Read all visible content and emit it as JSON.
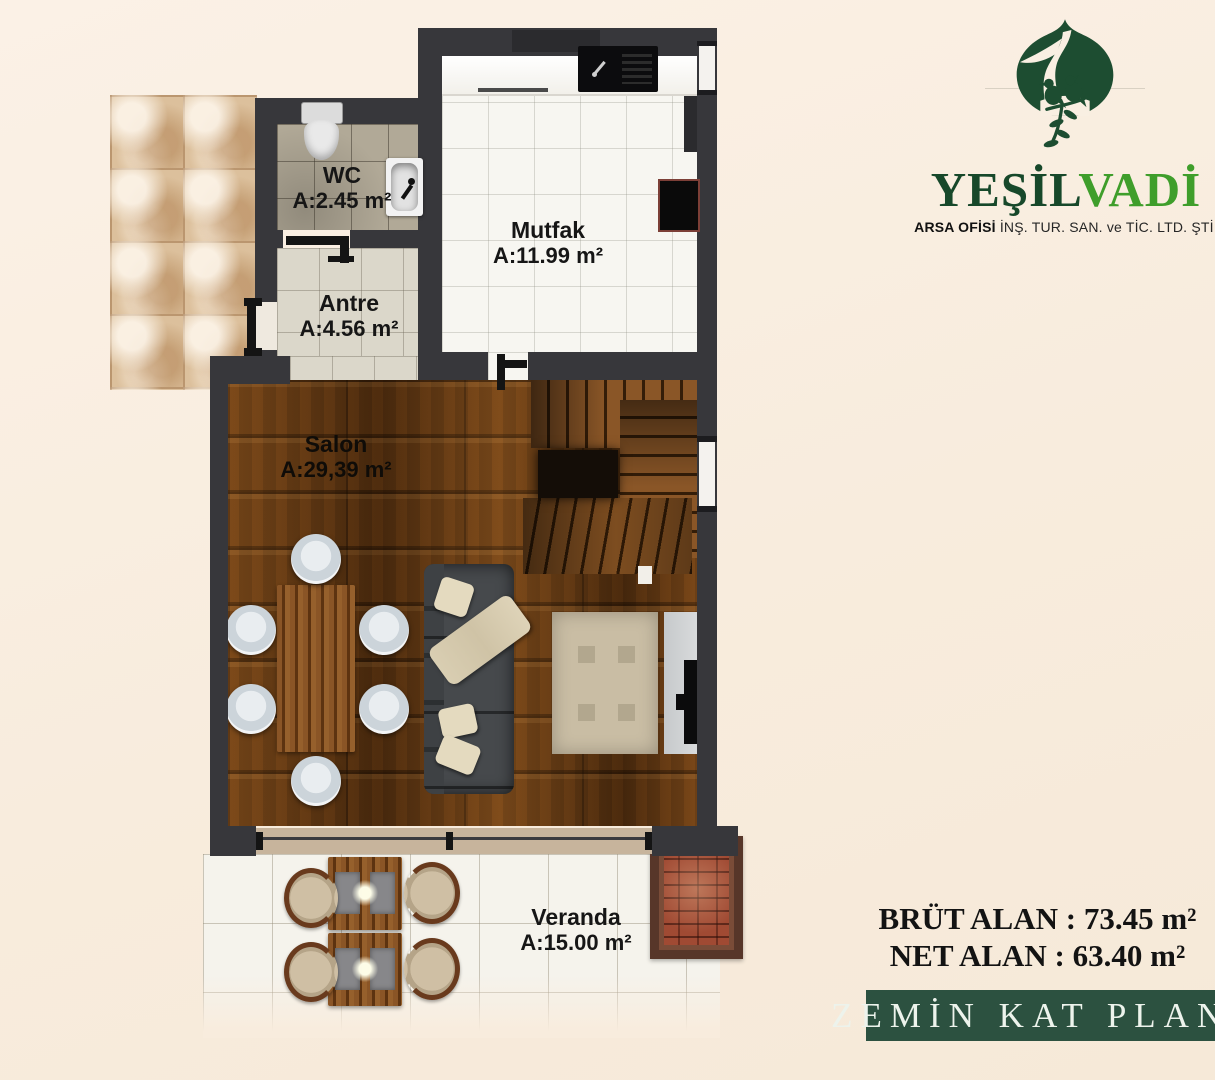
{
  "logo": {
    "brand_part1": "YEŞİL",
    "brand_part2": "VADİ",
    "tagline_bold": "ARSA OFİSİ",
    "tagline_rest": " İNŞ. TUR. SAN. ve TİC. LTD. ŞTİ.",
    "emblem": "valley-birds-emblem",
    "colors": {
      "dark_green": "#17482a",
      "light_green": "#3f9e2b"
    }
  },
  "plan": {
    "rooms": {
      "wc": {
        "name": "WC",
        "area": "A:2.45 m²"
      },
      "antre": {
        "name": "Antre",
        "area": "A:4.56 m²"
      },
      "mutfak": {
        "name": "Mutfak",
        "area": "A:11.99 m²"
      },
      "salon": {
        "name": "Salon",
        "area": "A:29,39 m²"
      },
      "veranda": {
        "name": "Veranda",
        "area": "A:15.00 m²"
      }
    }
  },
  "summary": {
    "brut_line": "BRÜT ALAN : 73.45 m²",
    "net_line": "NET ALAN : 63.40 m²"
  },
  "banner": {
    "title": "ZEMİN KAT PLANI"
  },
  "colors": {
    "banner_green": "#2c5140",
    "wall": "#37373b",
    "background": "#f8ecdd"
  }
}
